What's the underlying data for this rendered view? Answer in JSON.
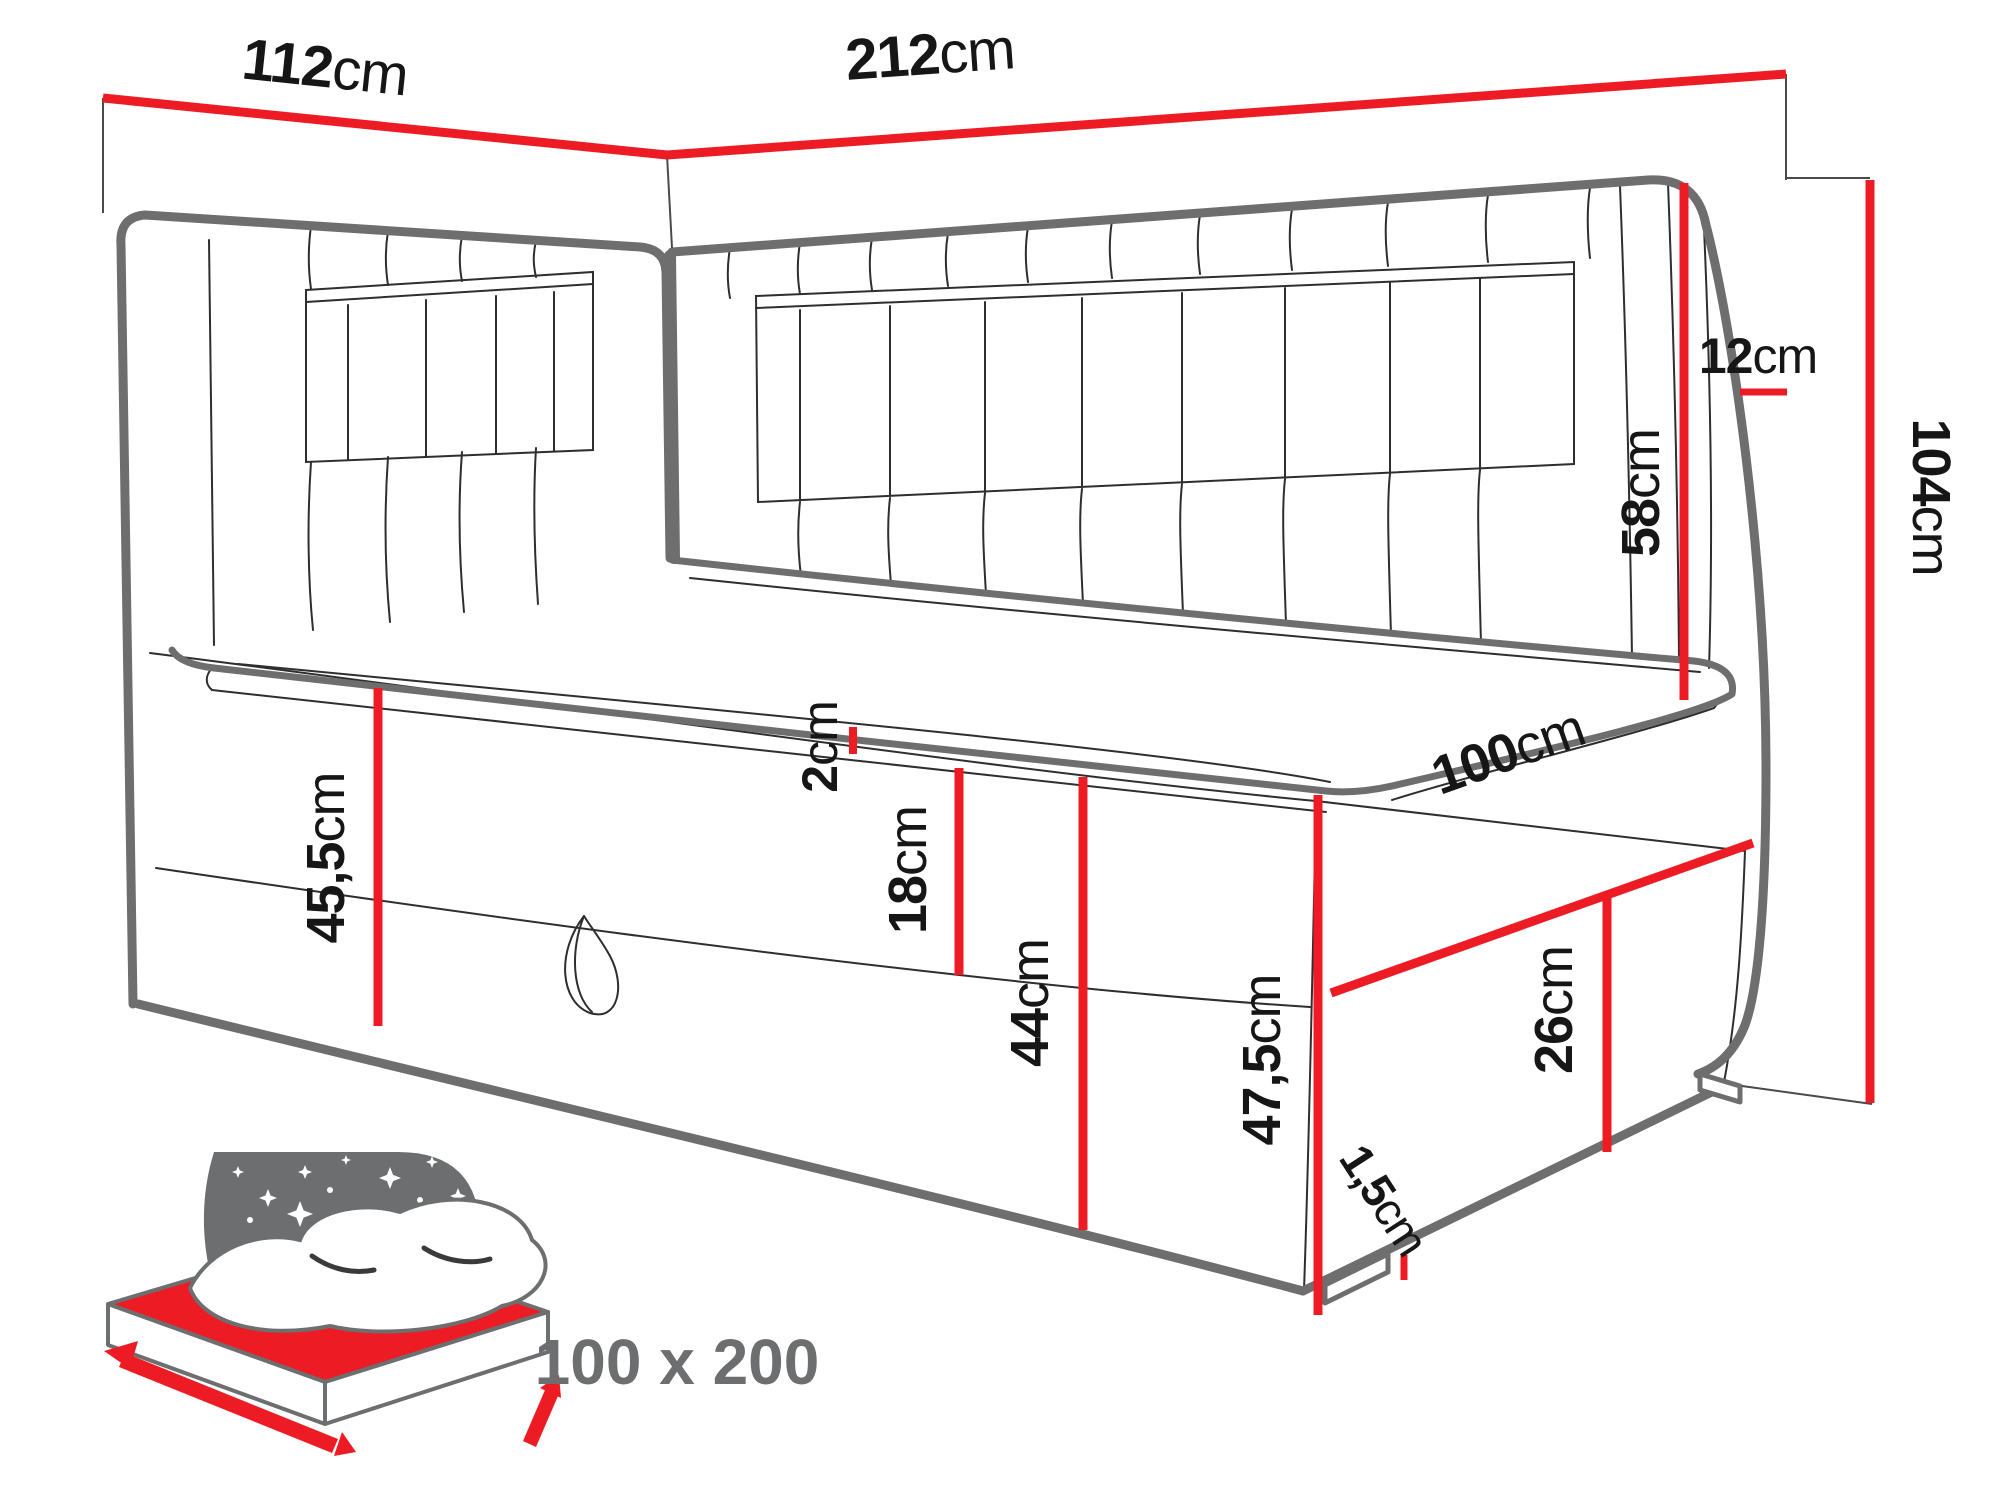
{
  "diagram": {
    "type": "furniture-dimension-drawing",
    "subject": "corner daybed with headboards and storage base",
    "accent_color": "#ed1c24",
    "line_color": "#6e6e6e",
    "label_color": "#161616",
    "icon_color": "#6d6e70",
    "dimensions": [
      {
        "id": "left-headboard-width",
        "value": "112",
        "unit": "cm"
      },
      {
        "id": "back-headboard-width",
        "value": "212",
        "unit": "cm"
      },
      {
        "id": "headboard-thickness",
        "value": "12",
        "unit": "cm"
      },
      {
        "id": "headboard-above-mattress",
        "value": "58",
        "unit": "cm"
      },
      {
        "id": "total-height",
        "value": "104",
        "unit": "cm"
      },
      {
        "id": "topper-thickness",
        "value": "2",
        "unit": "cm"
      },
      {
        "id": "upper-box-height",
        "value": "18",
        "unit": "cm"
      },
      {
        "id": "base-front-height",
        "value": "44",
        "unit": "cm"
      },
      {
        "id": "height-to-mattress-left",
        "value": "45,5",
        "unit": "cm"
      },
      {
        "id": "height-to-mattress-right",
        "value": "47,5",
        "unit": "cm"
      },
      {
        "id": "foot-end-width",
        "value": "100",
        "unit": "cm"
      },
      {
        "id": "foot-panel-height",
        "value": "26",
        "unit": "cm"
      },
      {
        "id": "leg-height",
        "value": "1,5",
        "unit": "cm"
      }
    ],
    "sleeping_area": {
      "label": "100 x 200"
    }
  }
}
